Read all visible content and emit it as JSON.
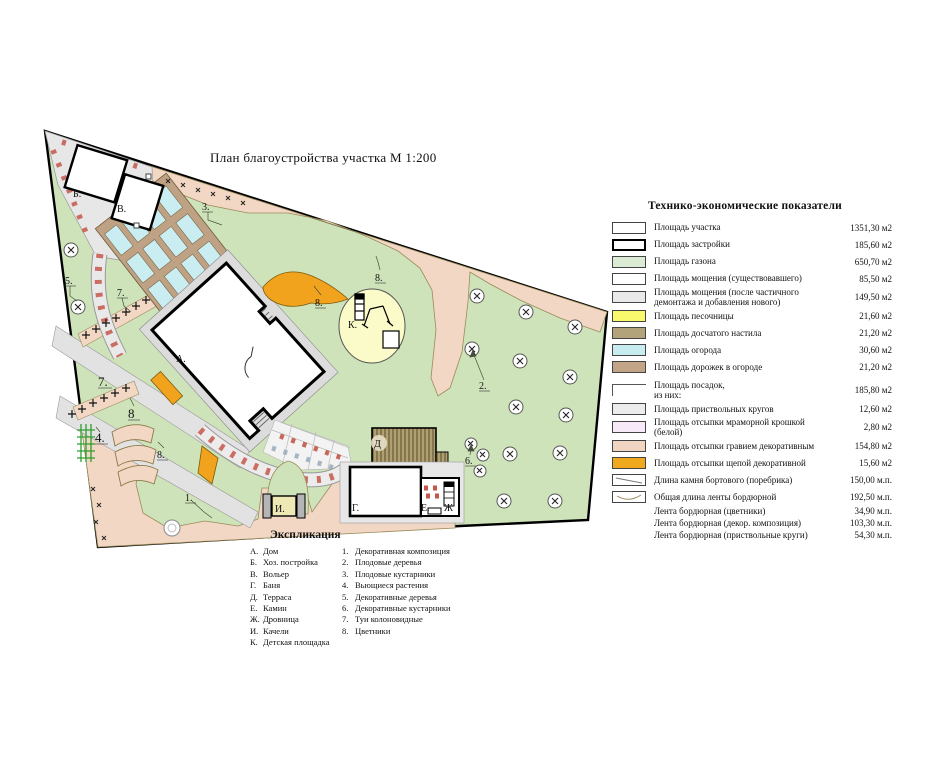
{
  "title": "План благоустройства участка  М 1:200",
  "legend": {
    "header": "Технико-экономические  показатели",
    "rows": [
      {
        "label": "Площадь участка",
        "value": "1351,30 м2",
        "swatch": "white"
      },
      {
        "label": "Площадь застройки",
        "value": "185,60 м2",
        "swatch": "outline-thick"
      },
      {
        "label": "Площадь газона",
        "value": "650,70 м2",
        "swatch": "light-green"
      },
      {
        "label": "Площадь мощения  (существовавшего)",
        "value": "85,50 м2",
        "swatch": "white"
      },
      {
        "label": "Площадь мощения (после частичного\nдемонтажа  и  добавления  нового)",
        "value": "149,50 м2",
        "swatch": "light-gray"
      },
      {
        "label": "Площадь песочницы",
        "value": "21,60 м2",
        "swatch": "yellow"
      },
      {
        "label": "Площадь досчатого настила",
        "value": "21,20 м2",
        "swatch": "khaki"
      },
      {
        "label": "Площадь огорода",
        "value": "30,60 м2",
        "swatch": "cyan"
      },
      {
        "label": "Площадь дорожек в огороде",
        "value": "21,20 м2",
        "swatch": "tan"
      }
    ],
    "rows2": [
      {
        "label": "Площадь посадок,\nиз них:",
        "value": "185,80 м2",
        "swatch": "bracket"
      },
      {
        "label": "Площадь приствольных кругов",
        "value": "12,60 м2",
        "swatch": "lighter-gray"
      },
      {
        "label": "Площадь отсыпки мраморной крошкой\n(белой)",
        "value": "2,80 м2",
        "swatch": "pink"
      },
      {
        "label": "Площадь отсыпки гравием декоративным",
        "value": "154,80 м2",
        "swatch": "light-peach"
      },
      {
        "label": "Площадь отсыпки щепой декоративной",
        "value": "15,60 м2",
        "swatch": "orange"
      },
      {
        "label": "Длина камня  бортового (поребрика)",
        "value": "150,00 м.п.",
        "swatch": "diagonal-line"
      },
      {
        "label": "Общая длина ленты бордюрной",
        "value": "192,50 м.п.",
        "swatch": "curve-line"
      },
      {
        "label": "Лента бордюрная (цветники)",
        "value": "34,90 м.п.",
        "swatch": "none"
      },
      {
        "label": "Лента бордюрная (декор. композиция)",
        "value": "103,30 м.п.",
        "swatch": "none"
      },
      {
        "label": "Лента бордюрная (приствольные круги)",
        "value": "54,30 м.п.",
        "swatch": "none"
      }
    ]
  },
  "explication": {
    "header": "Экспликация",
    "letters": [
      {
        "key": "А.",
        "label": "Дом"
      },
      {
        "key": "Б.",
        "label": "Хоз. постройка"
      },
      {
        "key": "В.",
        "label": "Вольер"
      },
      {
        "key": "Г.",
        "label": "Баня"
      },
      {
        "key": "Д.",
        "label": "Терраса"
      },
      {
        "key": "Е.",
        "label": "Камин"
      },
      {
        "key": "Ж.",
        "label": "Дровница"
      },
      {
        "key": "И.",
        "label": "Качели"
      },
      {
        "key": "К.",
        "label": "Детская площадка"
      }
    ],
    "numbers": [
      {
        "key": "1.",
        "label": "Декоративная композиция"
      },
      {
        "key": "2.",
        "label": "Плодовые деревья"
      },
      {
        "key": "3.",
        "label": "Плодовые кустарники"
      },
      {
        "key": "4.",
        "label": "Вьющиеся растения"
      },
      {
        "key": "5.",
        "label": "Декоративные деревья"
      },
      {
        "key": "6.",
        "label": "Декоративные кустарники"
      },
      {
        "key": "7.",
        "label": "Туи колоновидные"
      },
      {
        "key": "8.",
        "label": "Цветники"
      }
    ]
  },
  "plan": {
    "labels": [
      {
        "t": "А."
      },
      {
        "t": "Б."
      },
      {
        "t": "В."
      },
      {
        "t": "Г."
      },
      {
        "t": "Д"
      },
      {
        "t": "Е."
      },
      {
        "t": "Ж"
      },
      {
        "t": "И."
      },
      {
        "t": "К."
      },
      {
        "t": "1."
      },
      {
        "t": "2."
      },
      {
        "t": "3."
      },
      {
        "t": "4."
      },
      {
        "t": "5."
      },
      {
        "t": "6."
      },
      {
        "t": "7."
      },
      {
        "t": "7."
      },
      {
        "t": "8."
      },
      {
        "t": "8."
      },
      {
        "t": "8"
      },
      {
        "t": "8."
      }
    ]
  },
  "colors": {
    "lawn": "#cfe3ba",
    "gravel_peach": "#f2d8c4",
    "paving_gray": "#e7e7e7",
    "garden_bed_cyan": "#c9edf0",
    "garden_path_tan": "#bfa184",
    "sandbox_yellow": "#fbfbca",
    "woodchip_orange": "#f2a31d",
    "terrace_khaki": "#b0a070",
    "brick_red": "#c4574a",
    "legend_green": "#dcecd4",
    "legend_yellow": "#f9f96e",
    "legend_khaki": "#b3a37a",
    "legend_cyan": "#c8edf0",
    "legend_tan": "#c2a486",
    "legend_pink": "#f8e9f8",
    "legend_peach": "#f0d6c2",
    "legend_orange": "#f0a81f"
  }
}
